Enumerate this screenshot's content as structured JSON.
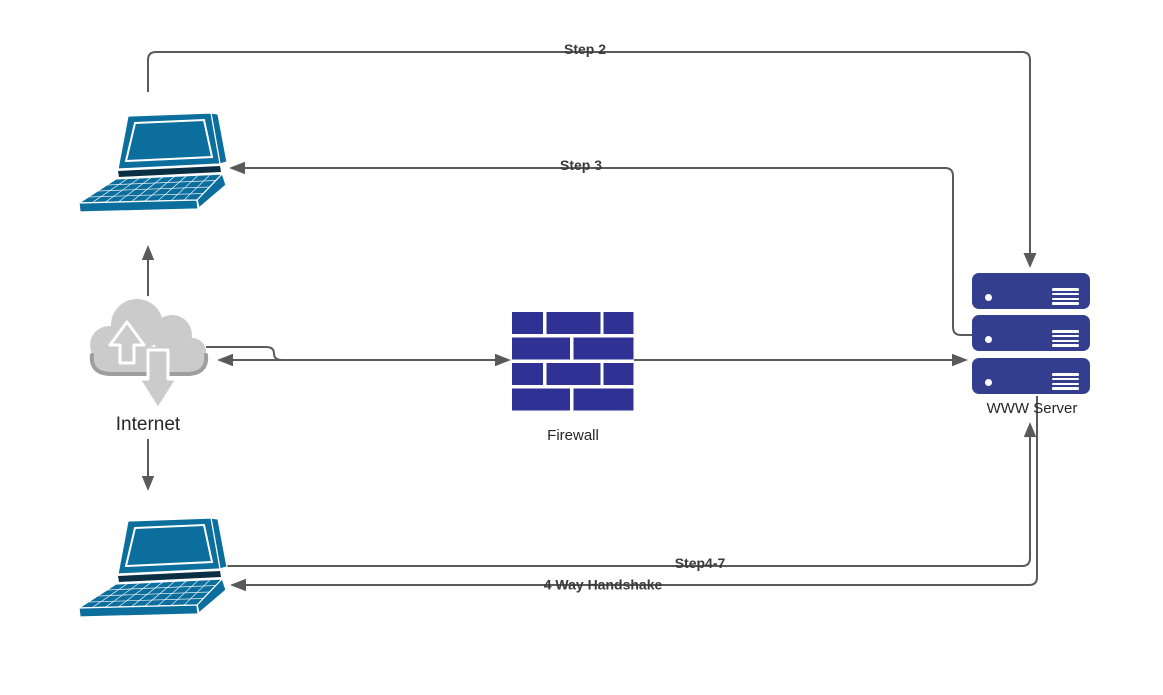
{
  "canvas": {
    "width": 1163,
    "height": 695,
    "background": "#ffffff"
  },
  "nodes": {
    "laptop_top": {
      "type": "laptop",
      "label": ""
    },
    "internet": {
      "type": "cloud",
      "label": "Internet"
    },
    "laptop_bottom": {
      "type": "laptop",
      "label": ""
    },
    "firewall": {
      "type": "brick-wall",
      "label": "Firewall"
    },
    "www_server": {
      "type": "server-stack",
      "label": "WWW Server",
      "units": 3
    }
  },
  "edges": {
    "step2": {
      "label": "Step 2",
      "from": "laptop_top",
      "to": "www_server",
      "arrow": "to"
    },
    "step3": {
      "label": "Step 3",
      "from": "www_server",
      "to": "laptop_top",
      "arrow": "to"
    },
    "internet_to_laptop_top": {
      "label": "",
      "from": "internet",
      "to": "laptop_top",
      "arrow": "to"
    },
    "internet_to_laptop_bottom": {
      "label": "",
      "from": "internet",
      "to": "laptop_bottom",
      "arrow": "to"
    },
    "internet_to_firewall": {
      "label": "",
      "from": "internet",
      "to": "firewall",
      "arrow": "to"
    },
    "firewall_to_internet": {
      "label": "",
      "from": "firewall",
      "to": "internet",
      "arrow": "to"
    },
    "firewall_to_server": {
      "label": "",
      "from": "firewall",
      "to": "www_server",
      "arrow": "to"
    },
    "step4_7": {
      "label": "Step4-7",
      "from": "laptop_bottom",
      "to": "www_server",
      "arrow": "to"
    },
    "handshake": {
      "label": "4 Way Handshake",
      "from": "www_server",
      "to": "laptop_bottom",
      "arrow": "to"
    }
  },
  "colors": {
    "laptop": "#0c6e9d",
    "laptop_dark": "#0a2e42",
    "server": "#333e8e",
    "firewall": "#2f3294",
    "connector": "#5a5a5a",
    "cloud": "#cbcbcb",
    "cloud_shadow": "#9e9e9e",
    "node_label": "#262626",
    "edge_label": "#3a3a3a",
    "background": "#ffffff",
    "icon_detail": "#ffffff"
  }
}
